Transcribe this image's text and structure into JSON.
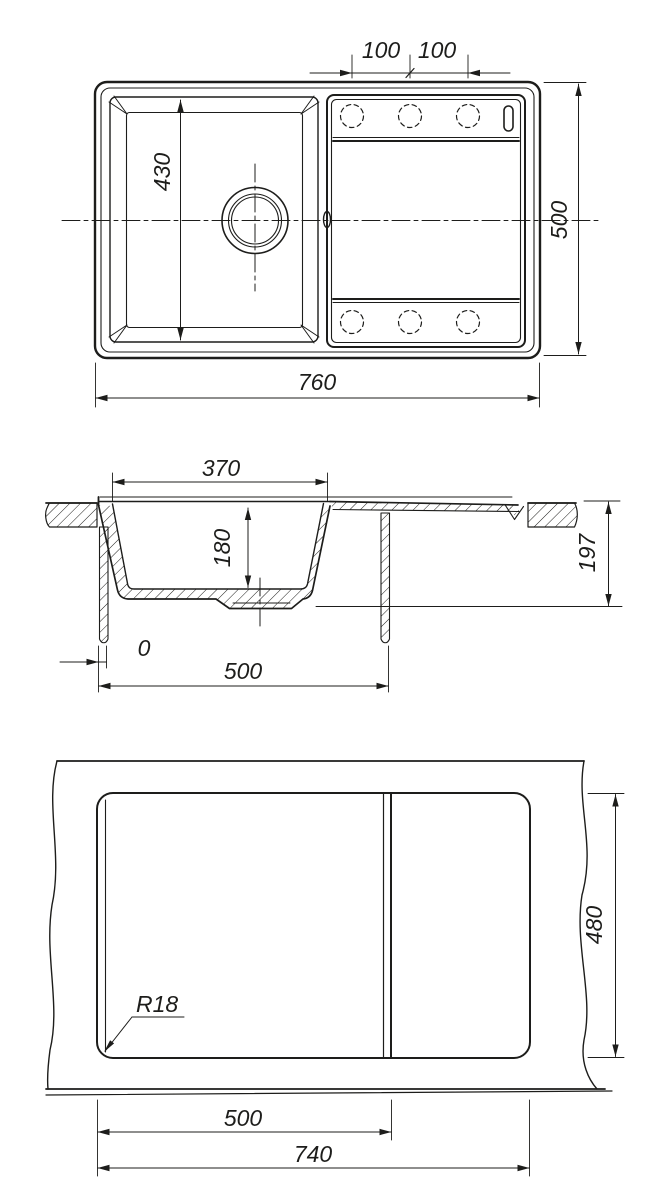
{
  "drawing": {
    "subject": "kitchen sink with drainboard - dimensioned technical drawing, three views",
    "line_color": "#1d1d1b",
    "background_color": "#ffffff",
    "top_view": {
      "name": "plan view",
      "dim_100_left": "100",
      "dim_100_right": "100",
      "dim_430": "430",
      "dim_500": "500",
      "dim_760": "760"
    },
    "section_view": {
      "name": "cross section",
      "dim_370": "370",
      "dim_180": "180",
      "dim_197": "197",
      "dim_0": "0",
      "dim_500": "500"
    },
    "cutout_view": {
      "name": "worktop cutout template",
      "dim_500": "500",
      "dim_740": "740",
      "dim_480": "480",
      "radius_label": "R18"
    }
  }
}
